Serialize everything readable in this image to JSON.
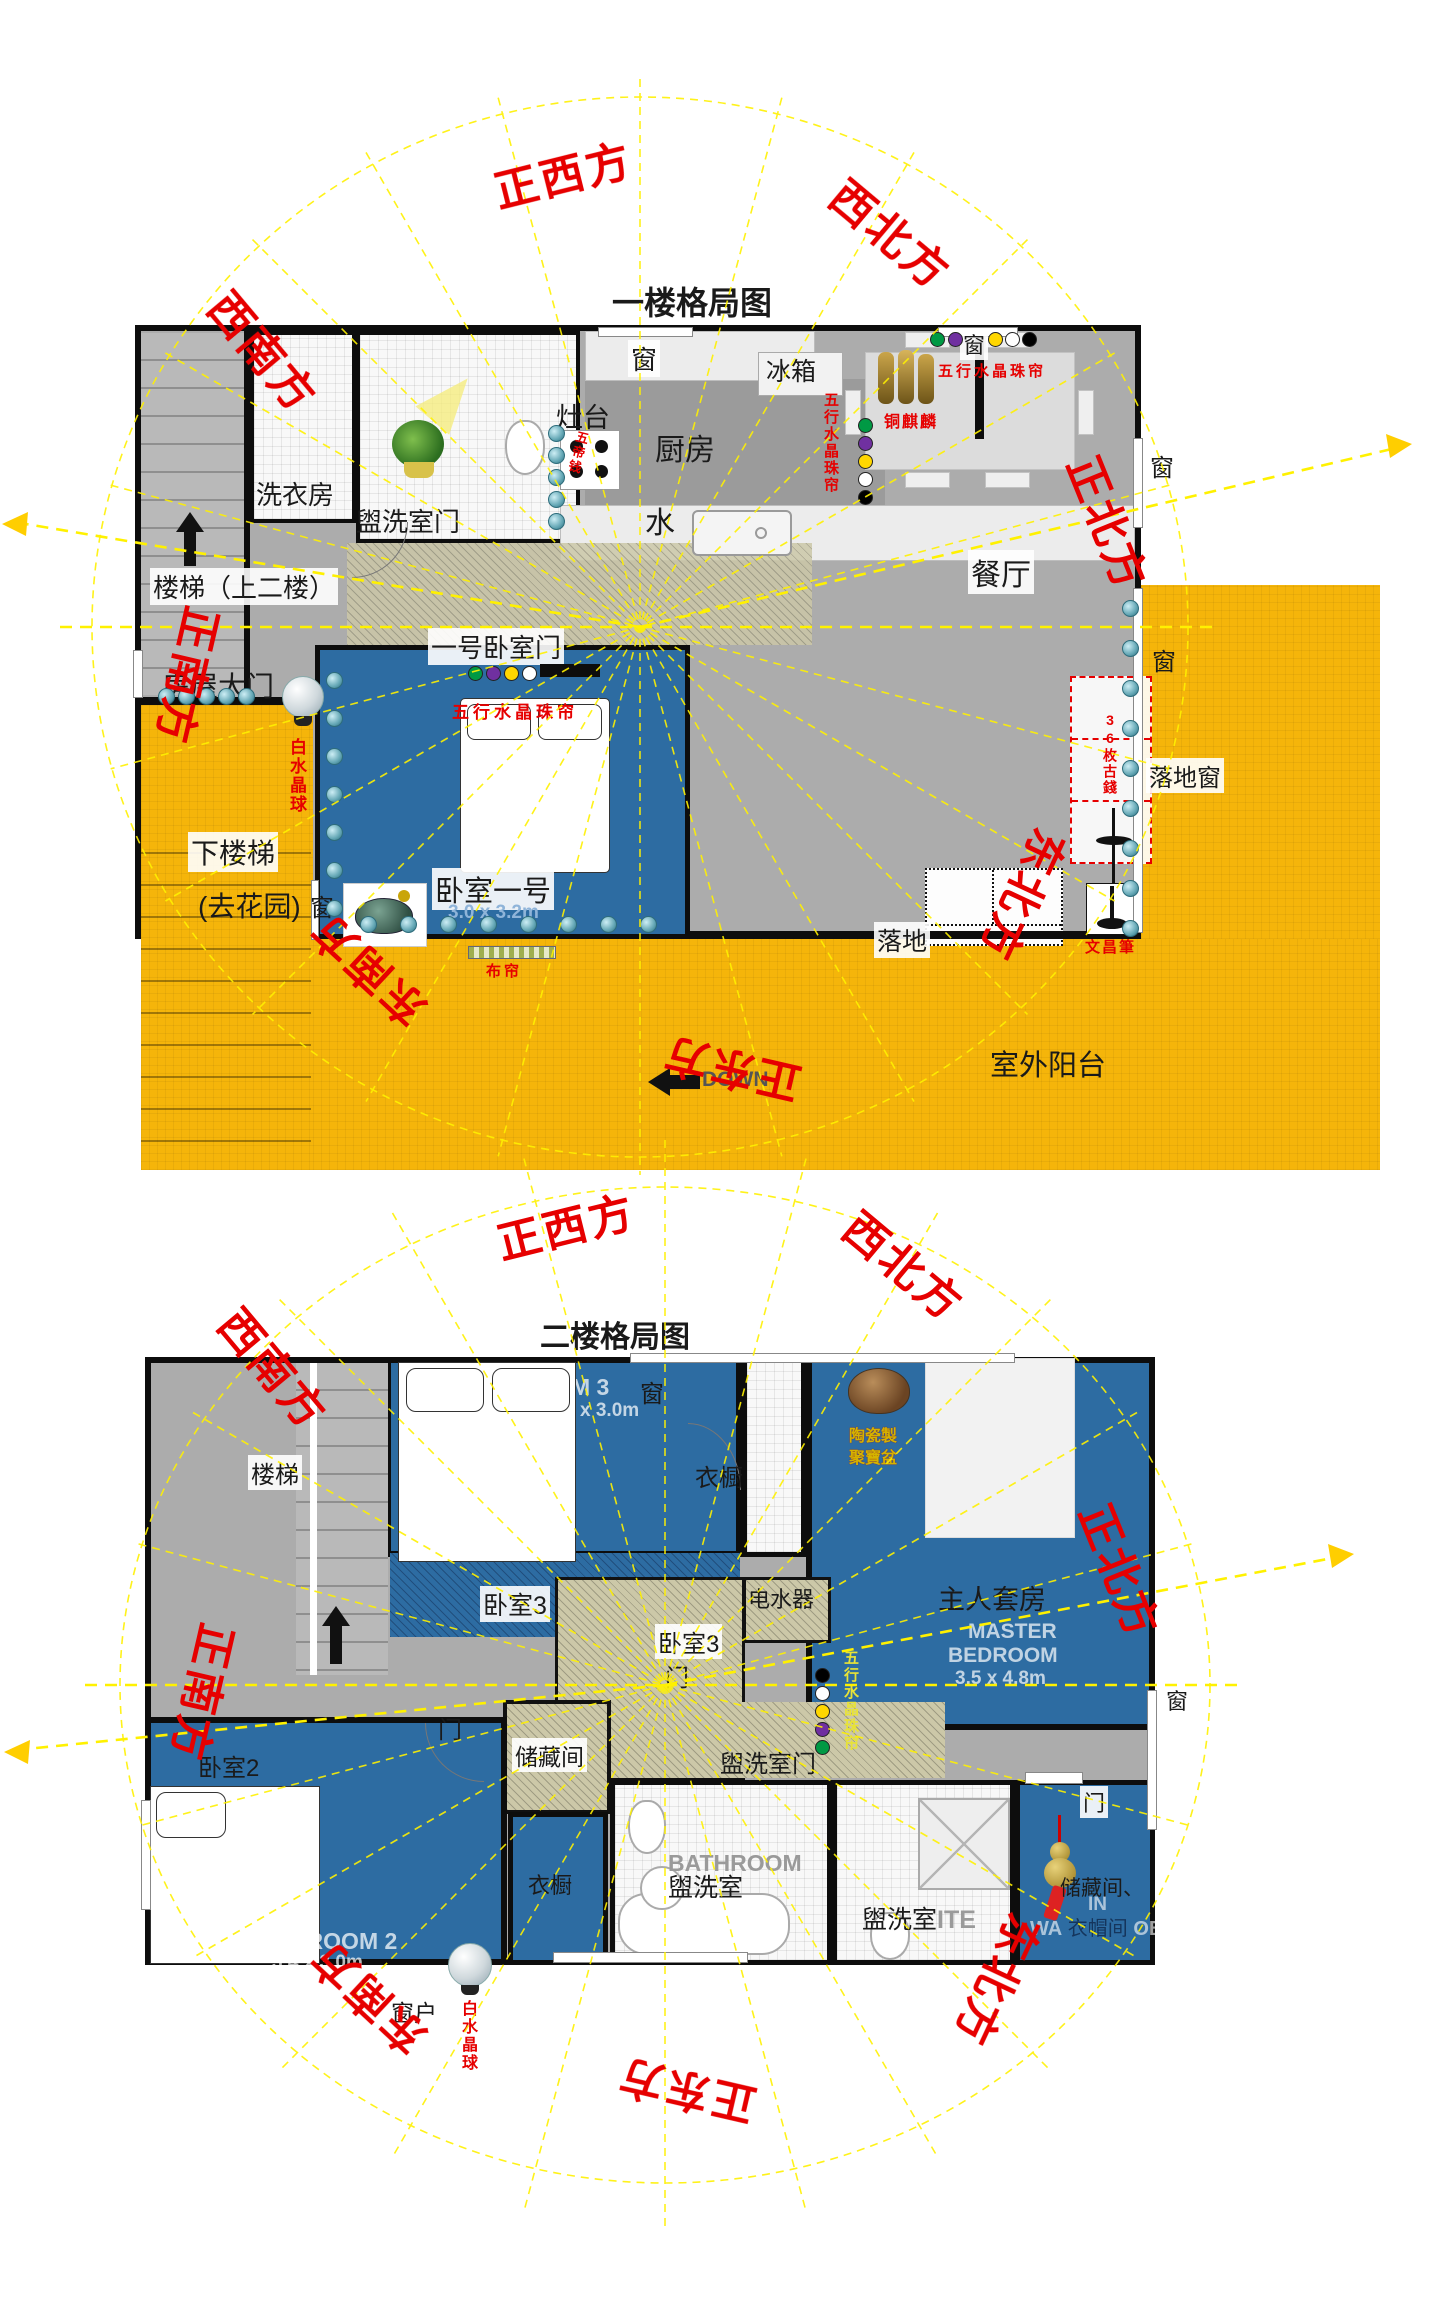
{
  "colors": {
    "wall": "#0d0d0d",
    "floor_gray": "#acacac",
    "room_blue": "#2d6ca2",
    "balcony_yellow": "#f5b50a",
    "compass_yellow": "#fff100",
    "label_red": "#e60000",
    "bead_colors": [
      "#009944",
      "#7030a0",
      "#ffd700",
      "#ffffff",
      "#000000"
    ]
  },
  "dirs": {
    "w": "正西方",
    "nw": "西北方",
    "n": "正北方",
    "ne": "东北方",
    "e": "正东方",
    "se": "东南方",
    "s": "正南方",
    "sw": "西南方"
  },
  "f1": {
    "title": "一楼格局图",
    "window": "窗",
    "fridge": "冰箱",
    "stove": "灶台",
    "kitchen": "厨房",
    "water": "水",
    "dining": "餐厅",
    "laundry": "洗衣房",
    "washroom_door": "盥洗室门",
    "stairs_up": "楼梯（上二楼）",
    "house_door": "房屋大门",
    "bedroom1_door": "一号卧室门",
    "bead_curtain": "五行水晶珠帘",
    "qilin": "铜麒麟",
    "five_coins": "五帝钱",
    "white_crystal": "白水晶球",
    "down_stairs": "下楼梯",
    "to_garden": "(去花园)",
    "bedroom1": "卧室一号",
    "bedroom1_dims": "3.0 x 3.2m",
    "curtain": "布帘",
    "coins36": "36枚古錢",
    "wenchang_pen": "文昌筆",
    "luodi": "落地",
    "balcony": "室外阳台",
    "down": "DOWN",
    "french_window": "落地窗"
  },
  "f2": {
    "title": "二楼格局图",
    "bedroom3_en": "BEDROOM 3",
    "bedroom3_dims": "x 3.0m",
    "window": "窗",
    "window_hu": "窗户",
    "wardrobe": "衣橱",
    "stairs": "楼梯",
    "bedroom3": "卧室3",
    "door": "门",
    "water_heater": "电水器",
    "master": "主人套房",
    "master_en1": "MASTER",
    "master_en2": "BEDROOM",
    "master_dims": "3.5 x 4.8m",
    "ceramic1": "陶瓷製",
    "ceramic2": "聚寶盆",
    "bead_curtain": "五行水晶珠帘",
    "storage": "储藏间",
    "washroom_door": "盥洗室门",
    "bedroom2": "卧室2",
    "bedroom2_en": "BEDROOM 2",
    "bedroom2_dims": "3.4 x 3.0m",
    "white_crystal": "白水晶球",
    "bathroom_en": "BATHROOM",
    "washroom": "盥洗室",
    "ensuite_frag": "ITE",
    "storage2": "储藏间、",
    "walkin_in": "IN",
    "walkin_wa": "WA",
    "closet": "衣帽间",
    "walkin_obe": "OBE"
  }
}
